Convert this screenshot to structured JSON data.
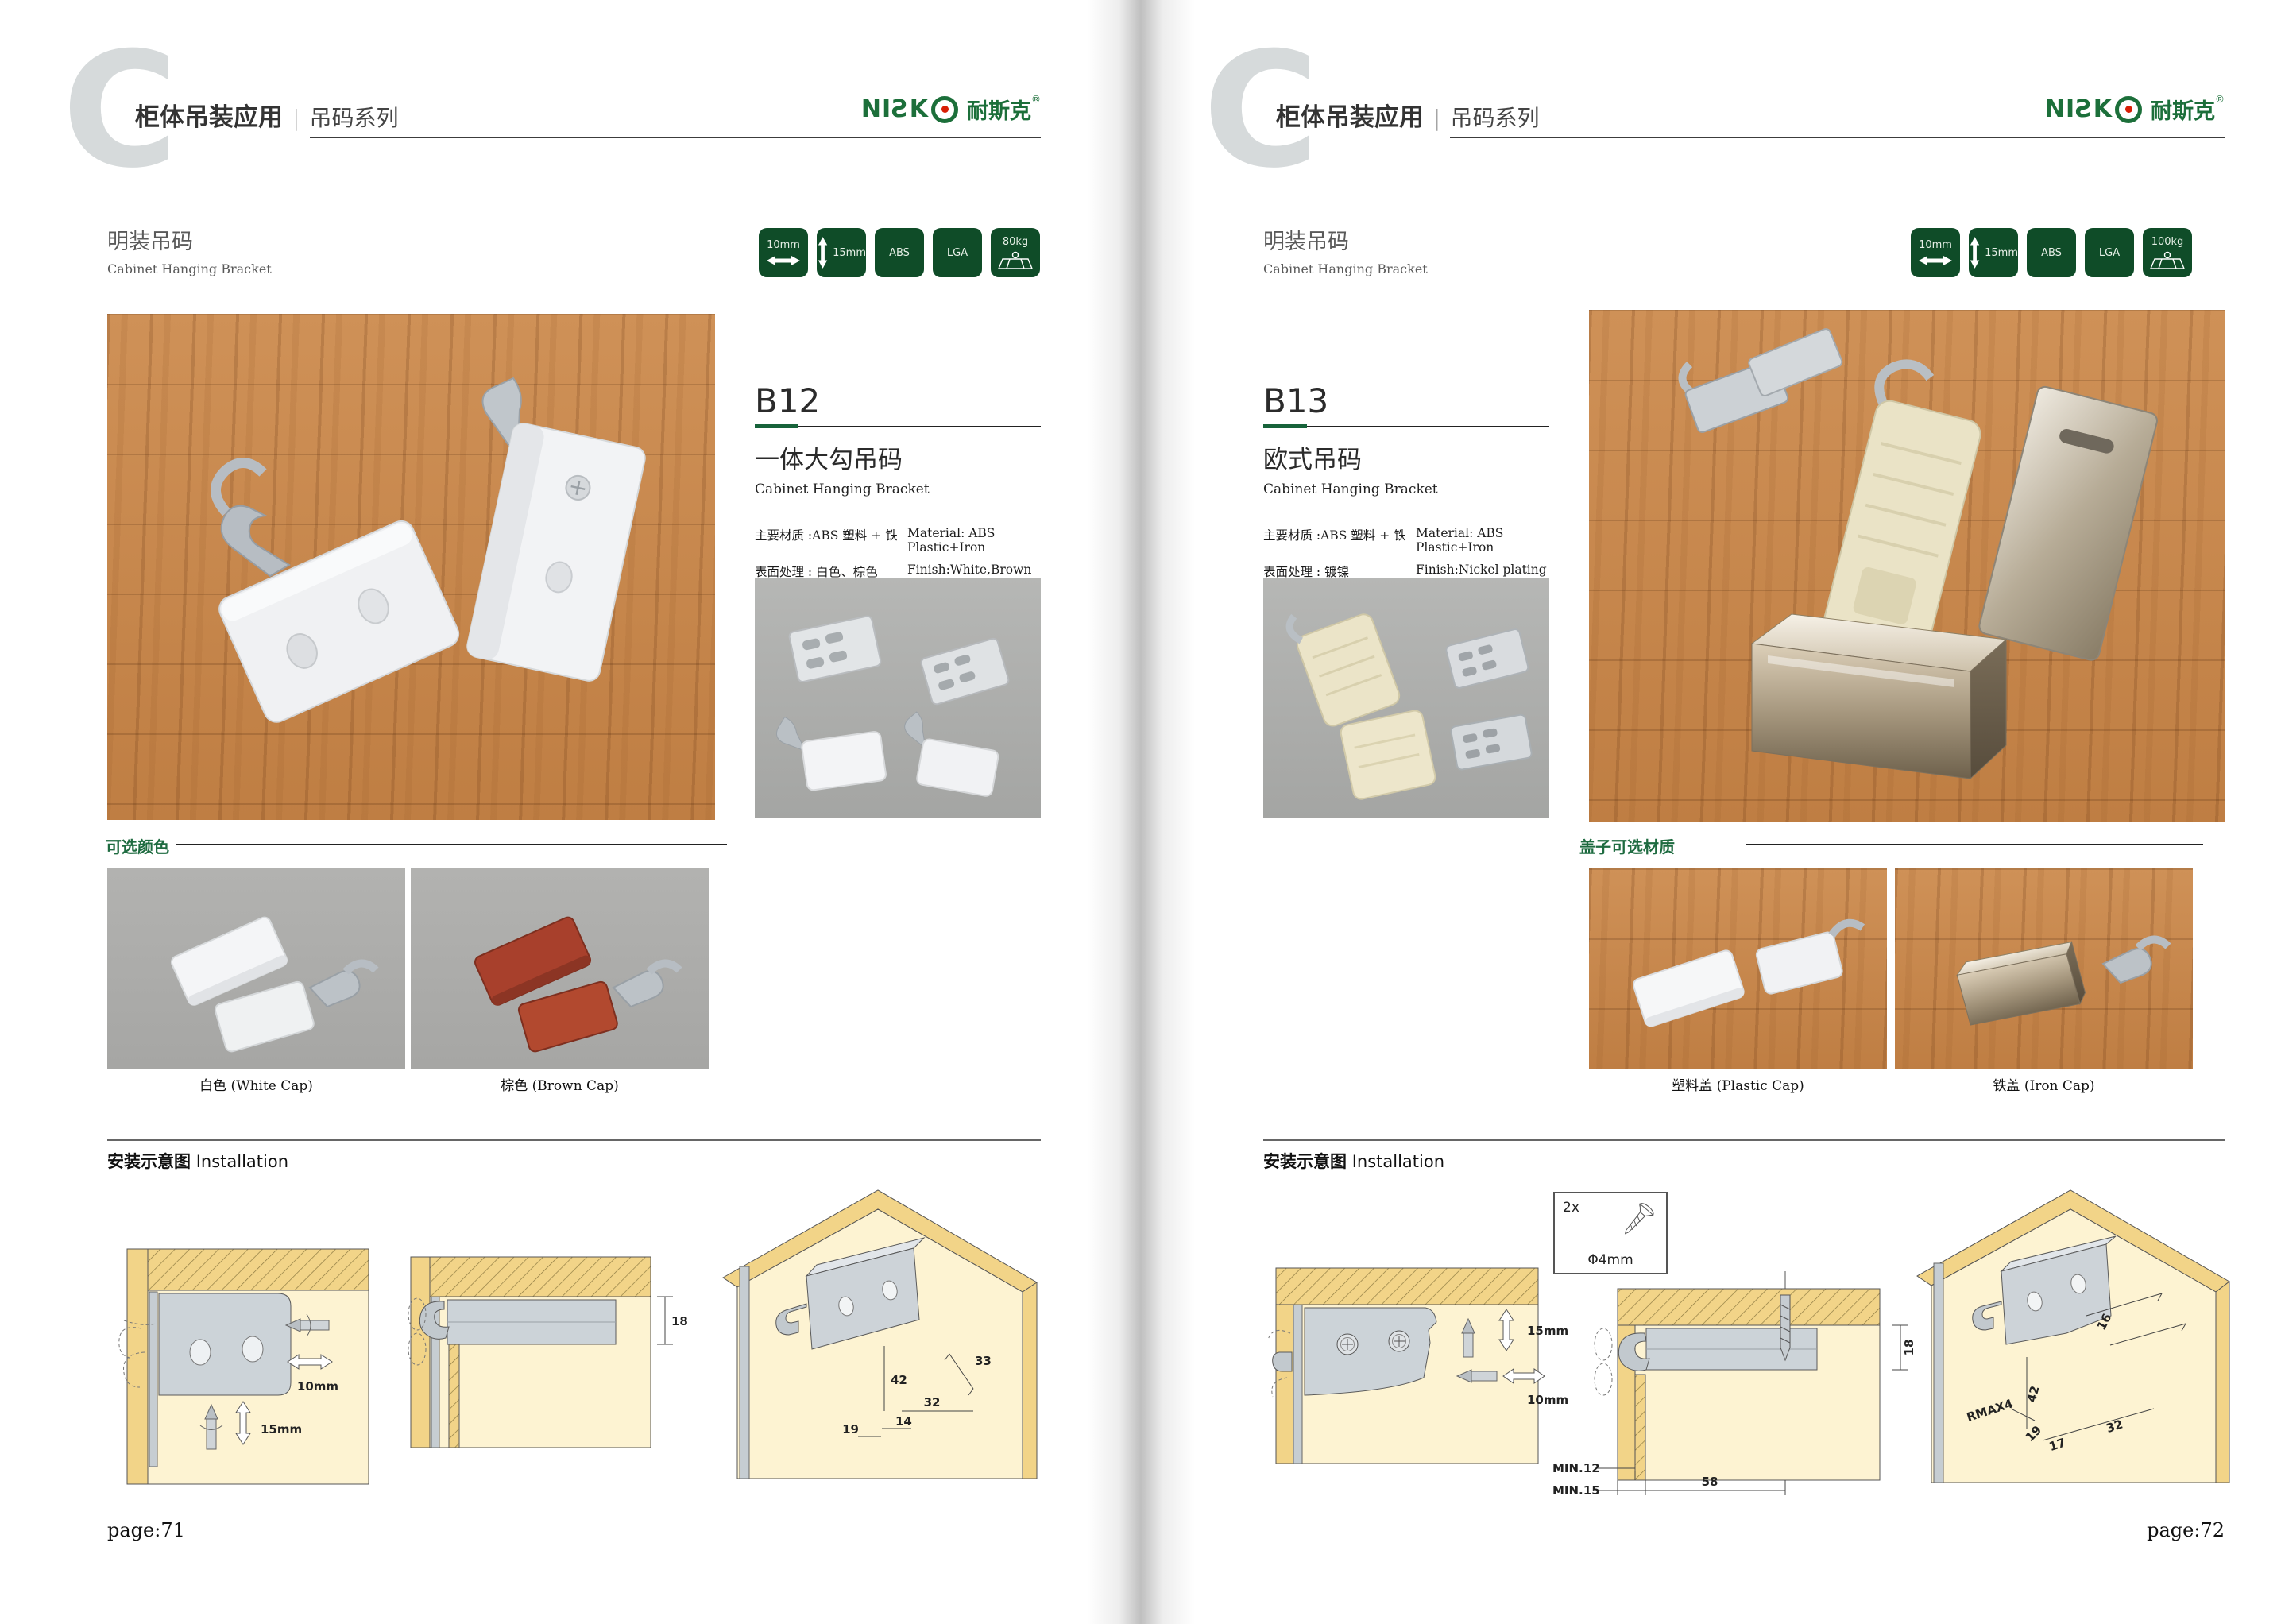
{
  "brand": {
    "latin": "NIƧK",
    "cjk": "耐斯克",
    "reg": "®"
  },
  "colors": {
    "badge_green": "#0f4c28",
    "logo_green": "#1c6f3a",
    "logo_red": "#d81e05",
    "label_green": "#1e6b40"
  },
  "pages": [
    {
      "page_no": "page:71",
      "header": {
        "letter": "C",
        "title": "柜体吊装应用",
        "divider": "|",
        "series": "吊码系列"
      },
      "section": {
        "title": "明装吊码",
        "subtitle": "Cabinet Hanging Bracket"
      },
      "badges": [
        "10mm",
        "15mm",
        "ABS",
        "LGA",
        "80kg"
      ],
      "product": {
        "code": "B12",
        "name": "一体大勾吊码",
        "name_en": "Cabinet Hanging Bracket",
        "material_cn": "主要材质 :ABS 塑料 + 铁",
        "material_en": "Material: ABS Plastic+Iron",
        "finish_cn": "表面处理 : 白色、棕色",
        "finish_en": "Finish:White,Brown"
      },
      "options": {
        "label": "可选颜色",
        "captions": [
          "白色 (White Cap)",
          "棕色 (Brown Cap)"
        ]
      },
      "install": {
        "label_cn": "安装示意图",
        "label_en": "Installation",
        "d1": [
          "10mm",
          "15mm"
        ],
        "d2": [
          "18"
        ],
        "d3": [
          "33",
          "42",
          "32",
          "14",
          "19"
        ]
      }
    },
    {
      "page_no": "page:72",
      "header": {
        "letter": "C",
        "title": "柜体吊装应用",
        "divider": "|",
        "series": "吊码系列"
      },
      "section": {
        "title": "明装吊码",
        "subtitle": "Cabinet Hanging Bracket"
      },
      "badges": [
        "10mm",
        "15mm",
        "ABS",
        "LGA",
        "100kg"
      ],
      "product": {
        "code": "B13",
        "name": "欧式吊码",
        "name_en": "Cabinet Hanging Bracket",
        "material_cn": "主要材质 :ABS 塑料 + 铁",
        "material_en": "Material: ABS Plastic+Iron",
        "finish_cn": "表面处理 : 镀镍",
        "finish_en": "Finish:Nickel plating"
      },
      "options": {
        "label": "盖子可选材质",
        "captions": [
          "塑料盖 (Plastic Cap)",
          "铁盖 (Iron Cap)"
        ]
      },
      "install": {
        "label_cn": "安装示意图",
        "label_en": "Installation",
        "screw_qty": "2x",
        "screw_dia": "Φ4mm",
        "d1": [
          "15mm",
          "10mm"
        ],
        "d2": [
          "18",
          "MIN.12",
          "MIN.15",
          "58"
        ],
        "d3": [
          "16",
          "42",
          "RMAX4",
          "19",
          "17",
          "32"
        ]
      }
    }
  ]
}
